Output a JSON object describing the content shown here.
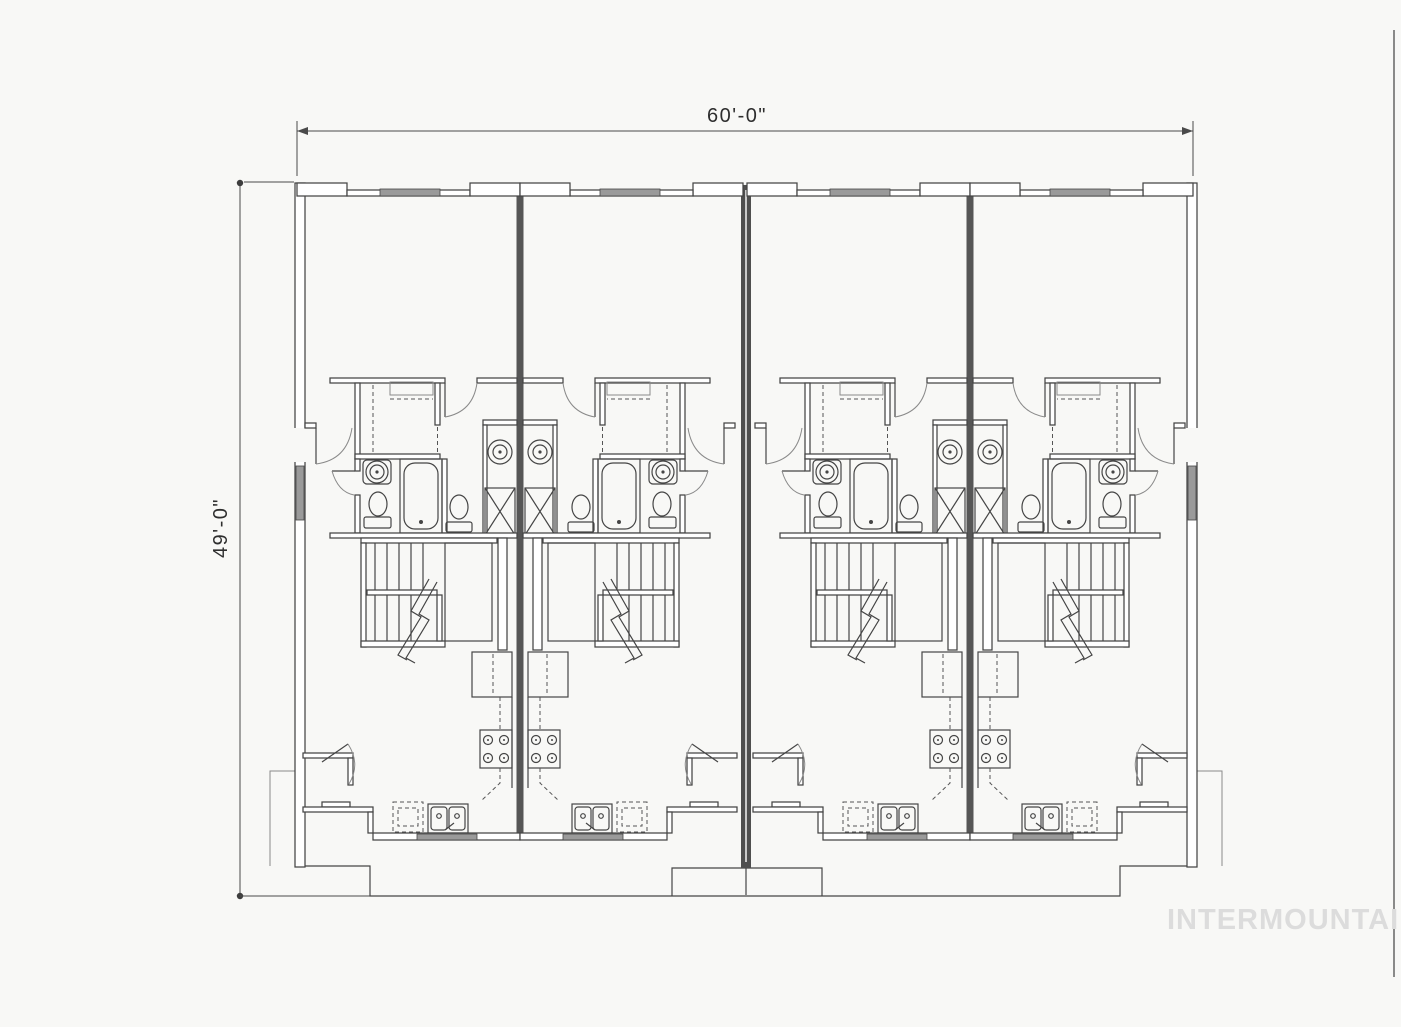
{
  "page": {
    "background": "#f8f8f6",
    "scan_edge_line_color": "#6e6e6e"
  },
  "drawing": {
    "type": "floor-plan",
    "unit_count": 4,
    "line_color": "#454545",
    "party_wall_color": "#4f4f4f",
    "window_fill": "#9a9a9a",
    "fixtures_depicted": [
      "walk-in-closet",
      "bathtub",
      "toilet",
      "pedestal-sink",
      "vanity-sink",
      "washer-dryer-stack",
      "switchback-stairs",
      "refrigerator",
      "range",
      "double-kitchen-sink",
      "dishwasher",
      "entry-door",
      "porch-stoop"
    ]
  },
  "dimensions": {
    "width_label": "60'-0\"",
    "height_label": "49'-0\""
  },
  "watermark": {
    "text": "INTERMOUNTAIN",
    "color": "#dcdcdc"
  }
}
